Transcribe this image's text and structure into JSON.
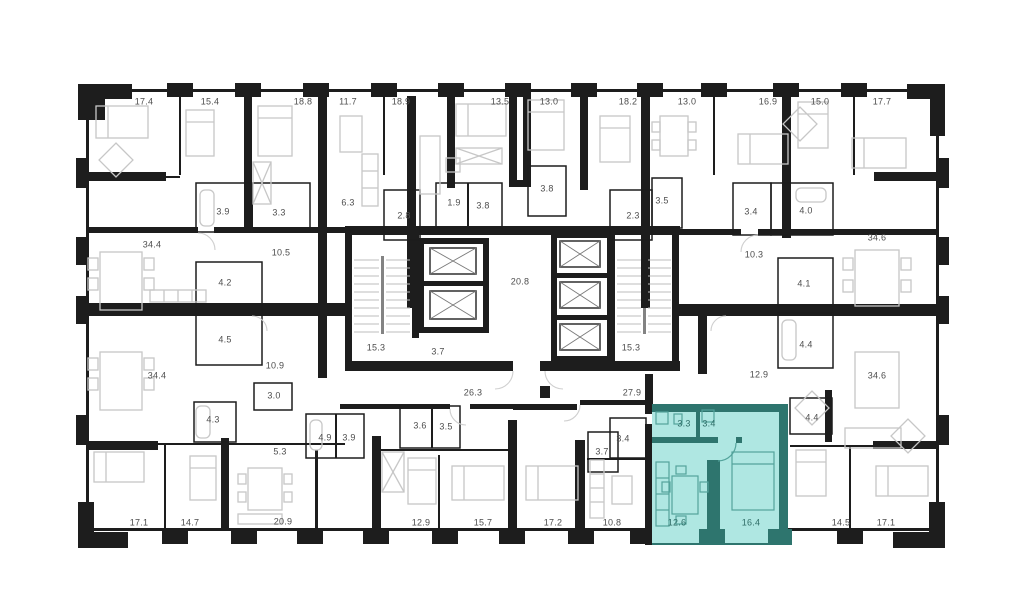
{
  "canvas": {
    "width": 1024,
    "height": 604,
    "background": "#ffffff"
  },
  "plan": {
    "colors": {
      "wall": "#1d1d1d",
      "furniture": "#c7c7c7",
      "stairs": "#bdbdbd",
      "door_arc": "#cfcfcf",
      "label": "#4d4d4d",
      "highlight_fill": "#afe7e2",
      "highlight_wall": "#2e756e",
      "highlight_furniture": "#53a39b",
      "highlight_label": "#2f6d67"
    },
    "highlighted_unit": {
      "room_areas": [
        "3.3",
        "3.4",
        "12.6",
        "16.4"
      ]
    },
    "room_labels": [
      {
        "area": "17.4",
        "x": 144,
        "y": 102,
        "hl": false
      },
      {
        "area": "15.4",
        "x": 210,
        "y": 102,
        "hl": false
      },
      {
        "area": "18.8",
        "x": 303,
        "y": 102,
        "hl": false
      },
      {
        "area": "11.7",
        "x": 348,
        "y": 102,
        "hl": false
      },
      {
        "area": "18.9",
        "x": 401,
        "y": 102,
        "hl": false
      },
      {
        "area": "13.5",
        "x": 500,
        "y": 102,
        "hl": false
      },
      {
        "area": "13.0",
        "x": 549,
        "y": 102,
        "hl": false
      },
      {
        "area": "18.2",
        "x": 628,
        "y": 102,
        "hl": false
      },
      {
        "area": "13.0",
        "x": 687,
        "y": 102,
        "hl": false
      },
      {
        "area": "16.9",
        "x": 768,
        "y": 102,
        "hl": false
      },
      {
        "area": "15.0",
        "x": 820,
        "y": 102,
        "hl": false
      },
      {
        "area": "17.7",
        "x": 882,
        "y": 102,
        "hl": false
      },
      {
        "area": "3.9",
        "x": 223,
        "y": 212,
        "hl": false
      },
      {
        "area": "3.3",
        "x": 279,
        "y": 213,
        "hl": false
      },
      {
        "area": "6.3",
        "x": 348,
        "y": 203,
        "hl": false
      },
      {
        "area": "2.8",
        "x": 404,
        "y": 216,
        "hl": false
      },
      {
        "area": "1.9",
        "x": 454,
        "y": 203,
        "hl": false
      },
      {
        "area": "3.8",
        "x": 483,
        "y": 206,
        "hl": false
      },
      {
        "area": "3.8",
        "x": 547,
        "y": 189,
        "hl": false
      },
      {
        "area": "2.3",
        "x": 633,
        "y": 216,
        "hl": false
      },
      {
        "area": "3.5",
        "x": 662,
        "y": 201,
        "hl": false
      },
      {
        "area": "3.4",
        "x": 751,
        "y": 212,
        "hl": false
      },
      {
        "area": "4.0",
        "x": 806,
        "y": 211,
        "hl": false
      },
      {
        "area": "34.4",
        "x": 152,
        "y": 245,
        "hl": false
      },
      {
        "area": "10.5",
        "x": 281,
        "y": 253,
        "hl": false
      },
      {
        "area": "10.3",
        "x": 754,
        "y": 255,
        "hl": false
      },
      {
        "area": "34.6",
        "x": 877,
        "y": 238,
        "hl": false
      },
      {
        "area": "4.2",
        "x": 225,
        "y": 283,
        "hl": false
      },
      {
        "area": "4.1",
        "x": 804,
        "y": 284,
        "hl": false
      },
      {
        "area": "20.8",
        "x": 520,
        "y": 282,
        "hl": false
      },
      {
        "area": "4.5",
        "x": 225,
        "y": 340,
        "hl": false
      },
      {
        "area": "4.4",
        "x": 806,
        "y": 345,
        "hl": false
      },
      {
        "area": "15.3",
        "x": 376,
        "y": 348,
        "hl": false
      },
      {
        "area": "3.7",
        "x": 438,
        "y": 352,
        "hl": false
      },
      {
        "area": "15.3",
        "x": 631,
        "y": 348,
        "hl": false
      },
      {
        "area": "34.4",
        "x": 157,
        "y": 376,
        "hl": false
      },
      {
        "area": "10.9",
        "x": 275,
        "y": 366,
        "hl": false
      },
      {
        "area": "12.9",
        "x": 759,
        "y": 375,
        "hl": false
      },
      {
        "area": "34.6",
        "x": 877,
        "y": 376,
        "hl": false
      },
      {
        "area": "26.3",
        "x": 473,
        "y": 393,
        "hl": false
      },
      {
        "area": "27.9",
        "x": 632,
        "y": 393,
        "hl": false
      },
      {
        "area": "3.0",
        "x": 274,
        "y": 396,
        "hl": false
      },
      {
        "area": "4.3",
        "x": 213,
        "y": 420,
        "hl": false
      },
      {
        "area": "4.9",
        "x": 325,
        "y": 438,
        "hl": false
      },
      {
        "area": "3.9",
        "x": 349,
        "y": 438,
        "hl": false
      },
      {
        "area": "3.6",
        "x": 420,
        "y": 426,
        "hl": false
      },
      {
        "area": "3.5",
        "x": 446,
        "y": 427,
        "hl": false
      },
      {
        "area": "5.3",
        "x": 280,
        "y": 452,
        "hl": false
      },
      {
        "area": "3.7",
        "x": 602,
        "y": 452,
        "hl": false
      },
      {
        "area": "3.4",
        "x": 623,
        "y": 439,
        "hl": false
      },
      {
        "area": "4.4",
        "x": 812,
        "y": 418,
        "hl": false
      },
      {
        "area": "3.3",
        "x": 684,
        "y": 424,
        "hl": true
      },
      {
        "area": "3.4",
        "x": 709,
        "y": 424,
        "hl": true
      },
      {
        "area": "12.6",
        "x": 677,
        "y": 523,
        "hl": true
      },
      {
        "area": "16.4",
        "x": 751,
        "y": 523,
        "hl": true
      },
      {
        "area": "17.1",
        "x": 139,
        "y": 523,
        "hl": false
      },
      {
        "area": "14.7",
        "x": 190,
        "y": 523,
        "hl": false
      },
      {
        "area": "20.9",
        "x": 283,
        "y": 522,
        "hl": false
      },
      {
        "area": "12.9",
        "x": 421,
        "y": 523,
        "hl": false
      },
      {
        "area": "15.7",
        "x": 483,
        "y": 523,
        "hl": false
      },
      {
        "area": "17.2",
        "x": 553,
        "y": 523,
        "hl": false
      },
      {
        "area": "10.8",
        "x": 612,
        "y": 523,
        "hl": false
      },
      {
        "area": "14.5",
        "x": 841,
        "y": 523,
        "hl": false
      },
      {
        "area": "17.1",
        "x": 886,
        "y": 523,
        "hl": false
      }
    ]
  }
}
